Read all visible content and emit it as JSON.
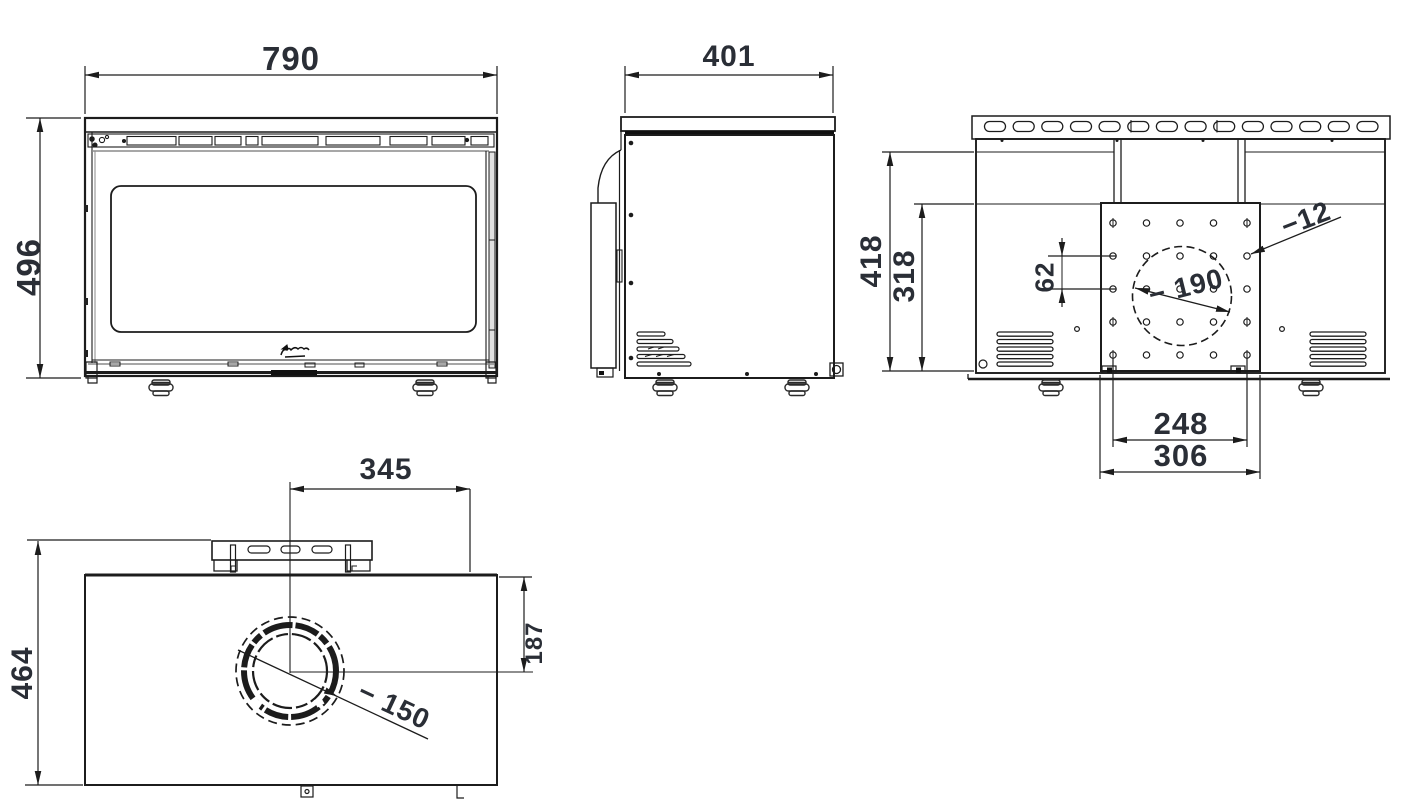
{
  "views": {
    "front": {
      "dim_width": "790",
      "dim_height": "496"
    },
    "side": {
      "dim_depth": "401"
    },
    "rear": {
      "dim_back_height": "418",
      "dim_plate_height": "318",
      "dim_hole_pitch": "62",
      "dim_hole_diameter": "−12",
      "dim_opening_diameter": "− 190",
      "dim_hole_span": "248",
      "dim_plate_width": "306"
    },
    "top": {
      "dim_depth": "464",
      "dim_flue_offset_right": "345",
      "dim_flue_offset_front": "187",
      "dim_flue_diameter": "− 150"
    }
  }
}
